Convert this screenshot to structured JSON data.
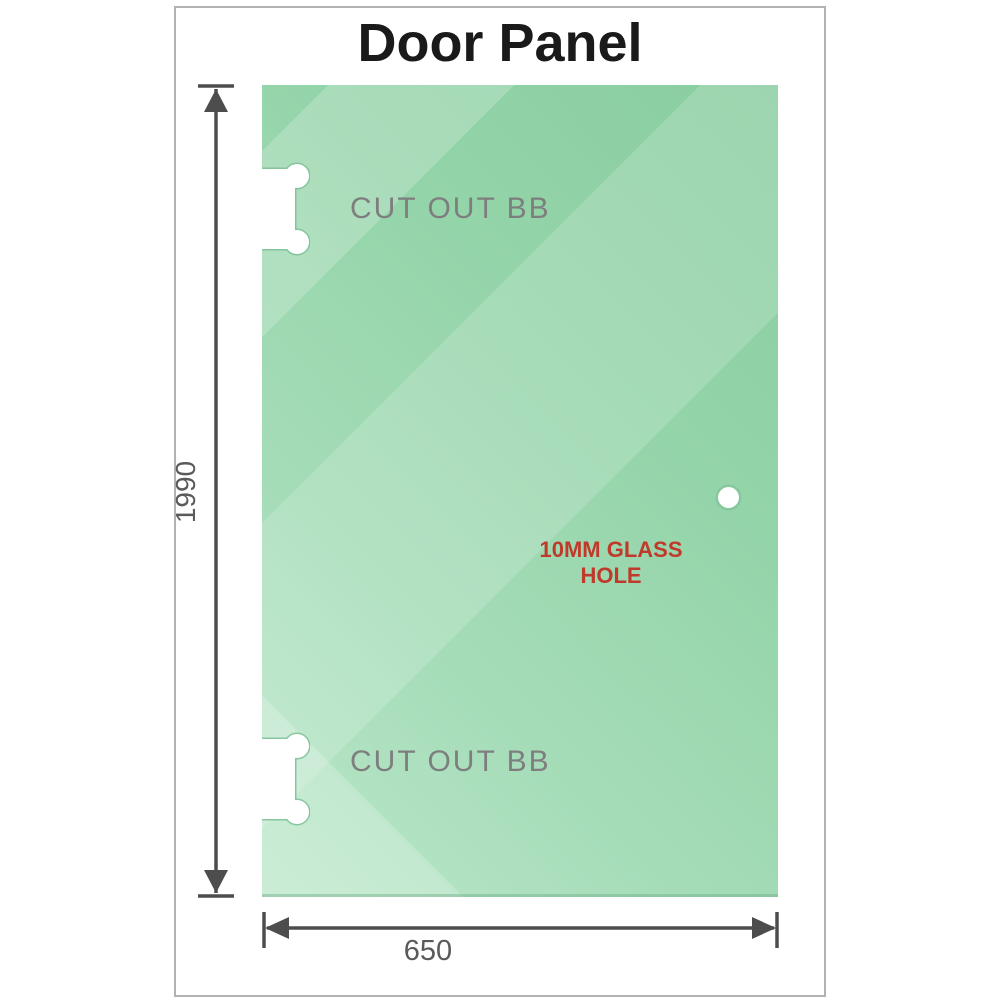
{
  "title": "Door Panel",
  "panel": {
    "cutout_top_label": "CUT OUT BB",
    "cutout_bottom_label": "CUT OUT BB",
    "hole_label": "10MM GLASS HOLE"
  },
  "dimensions": {
    "height_value": "1990",
    "width_value": "650"
  },
  "colors": {
    "glass_dark": "#89cda0",
    "glass_mid": "#9ad7ae",
    "glass_light": "#bce8cb",
    "cutout_outline": "#7cc096",
    "dimension_line": "#4d4d4d",
    "cutout_text": "#7e7e7e",
    "hole_text": "#c03a2b",
    "title_text": "#1a1a1a",
    "frame_border": "#b2b2b2"
  }
}
